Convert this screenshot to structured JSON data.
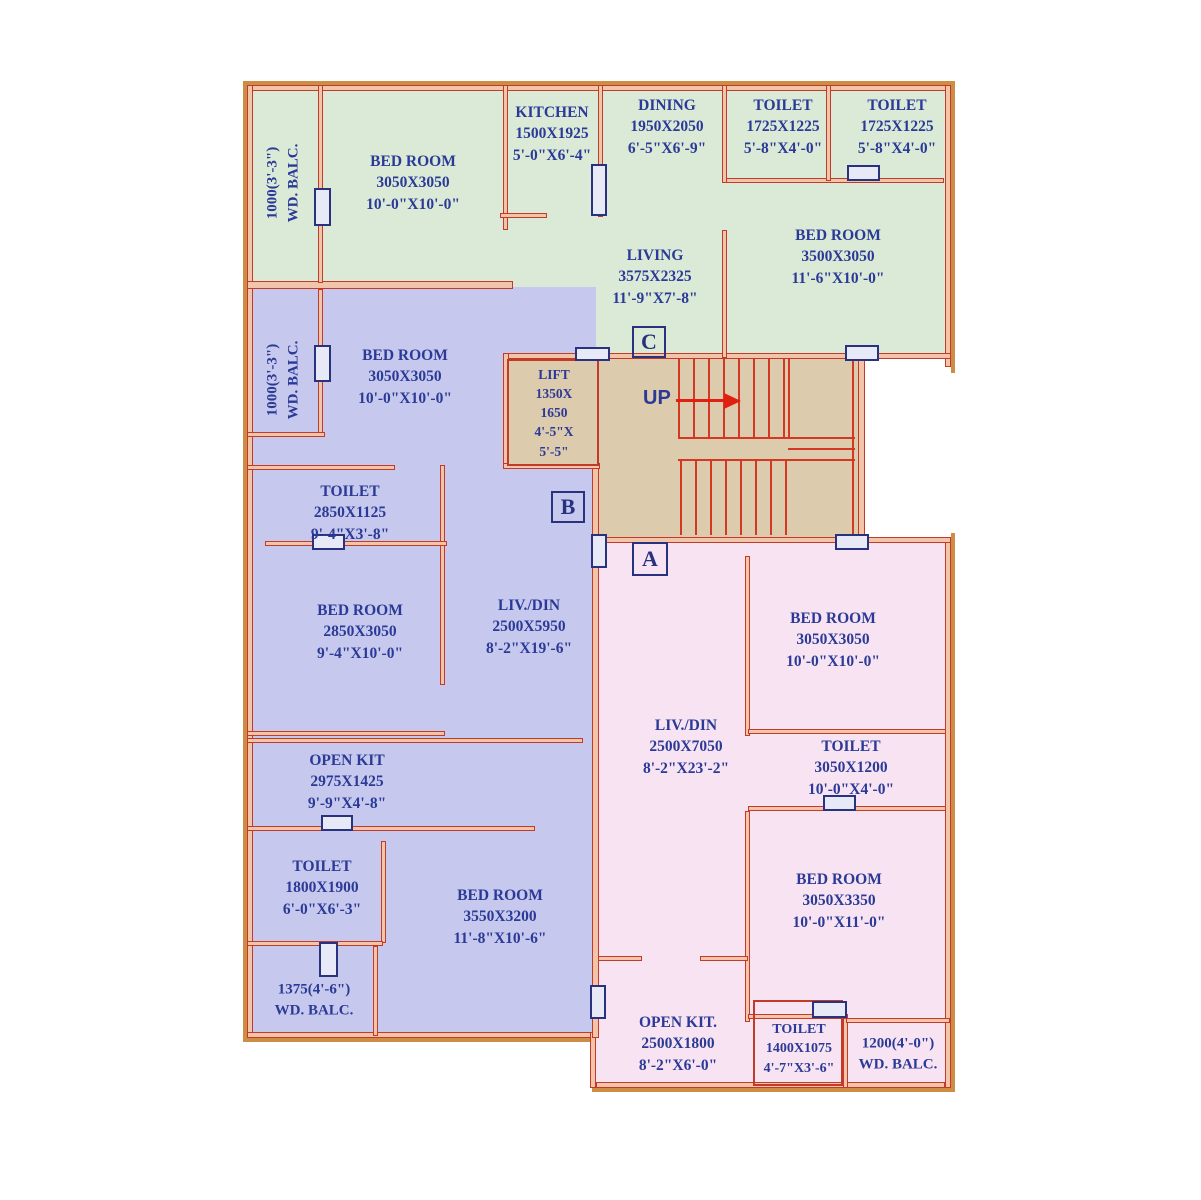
{
  "title": "Apartment floor plan with units A, B, C",
  "colors": {
    "unit_a_fill": "#f7e3f2",
    "unit_b_fill": "#c6c9ed",
    "unit_c_fill": "#dbead7",
    "stair_fill": "#ddcbae",
    "wall_fill": "#f2c4a9",
    "wall_line": "#c23a28",
    "outer_frame": "#cd8d45",
    "text_navy": "#2b3a96",
    "arrow_red": "#e02010"
  },
  "units": {
    "a": {
      "marker": "A"
    },
    "b": {
      "marker": "B"
    },
    "c": {
      "marker": "C"
    }
  },
  "rooms": [
    {
      "unit": "C",
      "label": "BED ROOM",
      "mm": "3050X3050",
      "ft": "10'-0\"X10'-0\""
    },
    {
      "unit": "C",
      "label": "KITCHEN",
      "mm": "1500X1925",
      "ft": "5'-0\"X6'-4\""
    },
    {
      "unit": "C",
      "label": "DINING",
      "mm": "1950X2050",
      "ft": "6'-5\"X6'-9\""
    },
    {
      "unit": "C",
      "label": "TOILET",
      "mm": "1725X1225",
      "ft": "5'-8\"X4'-0\""
    },
    {
      "unit": "C",
      "label": "TOILET",
      "mm": "1725X1225",
      "ft": "5'-8\"X4'-0\""
    },
    {
      "unit": "C",
      "label": "LIVING",
      "mm": "3575X2325",
      "ft": "11'-9\"X7'-8\""
    },
    {
      "unit": "C",
      "label": "BED ROOM",
      "mm": "3500X3050",
      "ft": "11'-6\"X10'-0\""
    },
    {
      "unit": "B",
      "label": "BED ROOM",
      "mm": "3050X3050",
      "ft": "10'-0\"X10'-0\""
    },
    {
      "unit": "B",
      "label": "TOILET",
      "mm": "2850X1125",
      "ft": "9'-4\"X3'-8\""
    },
    {
      "unit": "B",
      "label": "BED ROOM",
      "mm": "2850X3050",
      "ft": "9'-4\"X10'-0\""
    },
    {
      "unit": "B",
      "label": "LIV./DIN",
      "mm": "2500X5950",
      "ft": "8'-2\"X19'-6\""
    },
    {
      "unit": "B",
      "label": "OPEN KIT",
      "mm": "2975X1425",
      "ft": "9'-9\"X4'-8\""
    },
    {
      "unit": "B",
      "label": "TOILET",
      "mm": "1800X1900",
      "ft": "6'-0\"X6'-3\""
    },
    {
      "unit": "B",
      "label": "BED ROOM",
      "mm": "3550X3200",
      "ft": "11'-8\"X10'-6\""
    },
    {
      "unit": "A",
      "label": "BED ROOM",
      "mm": "3050X3050",
      "ft": "10'-0\"X10'-0\""
    },
    {
      "unit": "A",
      "label": "LIV./DIN",
      "mm": "2500X7050",
      "ft": "8'-2\"X23'-2\""
    },
    {
      "unit": "A",
      "label": "TOILET",
      "mm": "3050X1200",
      "ft": "10'-0\"X4'-0\""
    },
    {
      "unit": "A",
      "label": "BED ROOM",
      "mm": "3050X3350",
      "ft": "10'-0\"X11'-0\""
    },
    {
      "unit": "A",
      "label": "OPEN KIT.",
      "mm": "2500X1800",
      "ft": "8'-2\"X6'-0\""
    },
    {
      "unit": "A",
      "label": "TOILET",
      "mm": "1400X1075",
      "ft": "4'-7\"X3'-6\""
    }
  ],
  "balconies": [
    {
      "unit": "C",
      "size": "1000(3'-3\")",
      "label": "WD. BALC."
    },
    {
      "unit": "B",
      "size": "1000(3'-3\")",
      "label": "WD. BALC."
    },
    {
      "unit": "B",
      "size": "1375(4'-6\")",
      "label": "WD. BALC."
    },
    {
      "unit": "A",
      "size": "1200(4'-0\")",
      "label": "WD. BALC."
    }
  ],
  "lift": {
    "lines": [
      "LIFT",
      "1350X",
      "1650",
      "4'-5\"X",
      "5'-5\""
    ]
  },
  "stairs": {
    "up_label": "UP"
  }
}
